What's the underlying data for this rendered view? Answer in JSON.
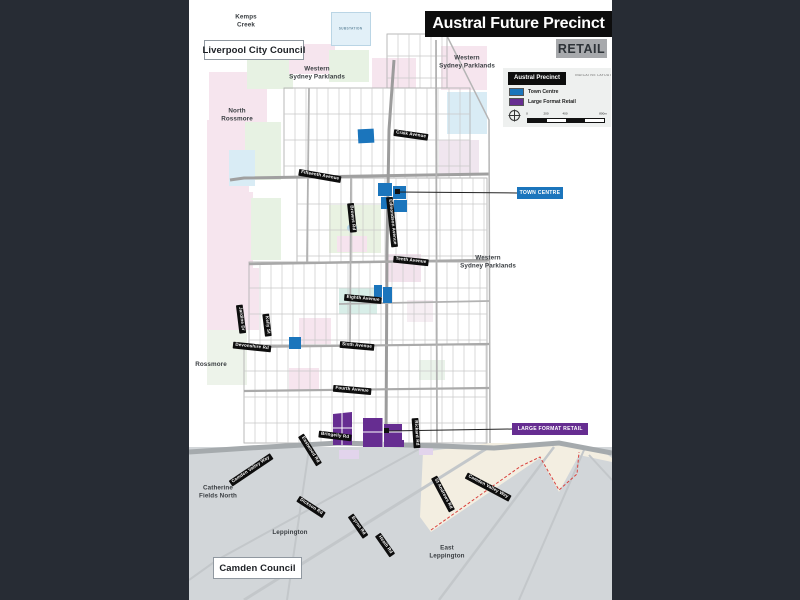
{
  "header": {
    "title": "Austral Future Precinct",
    "subtitle": "RETAIL"
  },
  "legend": {
    "title": "Austral Precinct",
    "note": "INDICATIVE LAYOUT PLAN",
    "items": [
      {
        "label": "Town Centre",
        "color": "#1b75bc"
      },
      {
        "label": "Large Format Retail",
        "color": "#662d91"
      }
    ],
    "scale_ticks": [
      "0",
      "200",
      "400",
      "800m"
    ]
  },
  "callouts": [
    {
      "label": "TOWN CENTRE",
      "color": "#1b75bc",
      "x": 328,
      "y": 187,
      "w": 46,
      "h": 12
    },
    {
      "label": "LARGE FORMAT RETAIL",
      "color": "#662d91",
      "x": 323,
      "y": 423,
      "w": 76,
      "h": 12
    }
  ],
  "council_labels": [
    {
      "text": "Liverpool City Council",
      "x": 15,
      "y": 40,
      "w": 98,
      "h": 18
    },
    {
      "text": "Camden Council",
      "x": 24,
      "y": 557,
      "w": 87,
      "h": 20
    }
  ],
  "region_labels": [
    {
      "text": "Kemps\nCreek",
      "cx": 57,
      "cy": 21
    },
    {
      "text": "Western\nSydney Parklands",
      "cx": 128,
      "cy": 73
    },
    {
      "text": "Western\nSydney Parklands",
      "cx": 278,
      "cy": 62
    },
    {
      "text": "North\nRossmore",
      "cx": 48,
      "cy": 115
    },
    {
      "text": "Western\nSydney Parklands",
      "cx": 299,
      "cy": 262
    },
    {
      "text": "Rossmore",
      "cx": 22,
      "cy": 365
    },
    {
      "text": "Catherine\nFields North",
      "cx": 29,
      "cy": 492
    },
    {
      "text": "Leppington",
      "cx": 101,
      "cy": 533
    },
    {
      "text": "East\nLeppington",
      "cx": 258,
      "cy": 552
    }
  ],
  "substation_label": "SUBSTATION",
  "road_labels": [
    {
      "text": "Craik Avenue",
      "cx": 222,
      "cy": 135,
      "rot": 8
    },
    {
      "text": "Fifteenth Avenue",
      "cx": 131,
      "cy": 176,
      "rot": 10
    },
    {
      "text": "Browns Rd",
      "cx": 163,
      "cy": 218,
      "rot": 84
    },
    {
      "text": "Edmondson Avenue",
      "cx": 203,
      "cy": 222,
      "rot": 84
    },
    {
      "text": "Tenth Avenue",
      "cx": 222,
      "cy": 261,
      "rot": 6
    },
    {
      "text": "Eighth Avenue",
      "cx": 174,
      "cy": 299,
      "rot": 5
    },
    {
      "text": "Jardine Dr",
      "cx": 52,
      "cy": 319,
      "rot": 83
    },
    {
      "text": "Kelly St",
      "cx": 78,
      "cy": 325,
      "rot": 83
    },
    {
      "text": "Devonshire Rd",
      "cx": 63,
      "cy": 347,
      "rot": 6
    },
    {
      "text": "Sixth Avenue",
      "cx": 168,
      "cy": 346,
      "rot": 5
    },
    {
      "text": "Fourth Avenue",
      "cx": 163,
      "cy": 390,
      "rot": 5
    },
    {
      "text": "Bringelly Rd",
      "cx": 146,
      "cy": 436,
      "rot": 7
    },
    {
      "text": "Rickard Rd",
      "cx": 227,
      "cy": 433,
      "rot": 86
    },
    {
      "text": "Camden Valley Way",
      "cx": 62,
      "cy": 470,
      "rot": -34
    },
    {
      "text": "Eastwood Rd",
      "cx": 121,
      "cy": 450,
      "rot": 58
    },
    {
      "text": "Dickson Rd",
      "cx": 122,
      "cy": 507,
      "rot": 33
    },
    {
      "text": "Byron Rd",
      "cx": 169,
      "cy": 526,
      "rot": 55
    },
    {
      "text": "Heath Rd",
      "cx": 196,
      "cy": 545,
      "rot": 55
    },
    {
      "text": "St Andrews Rd",
      "cx": 254,
      "cy": 494,
      "rot": 62
    },
    {
      "text": "Camden Valley Way",
      "cx": 299,
      "cy": 487,
      "rot": 28
    }
  ],
  "colors": {
    "surround": "#272c34",
    "page": "#ffffff",
    "town_centre": "#1b75bc",
    "large_format_retail": "#662d91",
    "camden_area": "#d2d6d9",
    "boundary_dash": "#d9413d"
  }
}
